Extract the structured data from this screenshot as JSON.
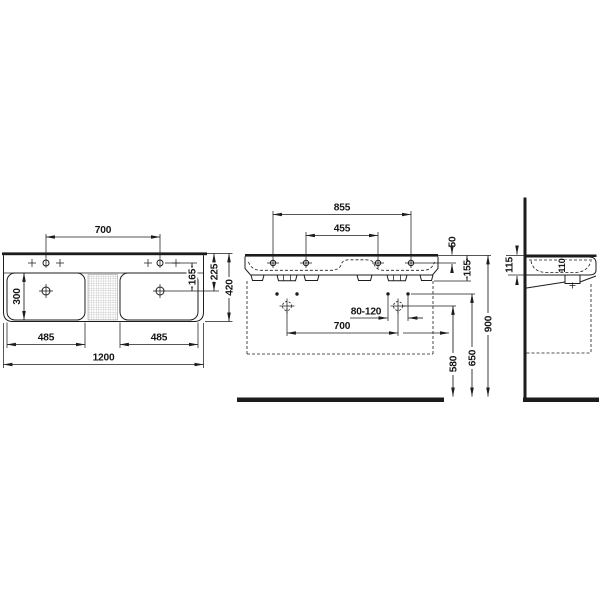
{
  "drawing": {
    "product": "double-washbasin-technical-drawing",
    "views": {
      "plan": {
        "tap_hole_spacing": "700",
        "basin_depth": "300",
        "basin_width_left": "485",
        "basin_width_right": "485",
        "overall_width": "1200",
        "tap_to_drain": "165",
        "rear_to_drain": "225",
        "overall_depth": "420"
      },
      "front": {
        "hanger_spacing_outer": "855",
        "hanger_spacing_inner": "455",
        "rim_to_tap_holes": "50",
        "rim_to_hangers": "155",
        "drain_offset_range": "80-120",
        "drain_spacing": "700",
        "drain_height": "580",
        "hanger_height": "650",
        "rim_height": "900"
      },
      "side": {
        "apron_height": "115",
        "basin_inner_depth": "110"
      }
    }
  }
}
